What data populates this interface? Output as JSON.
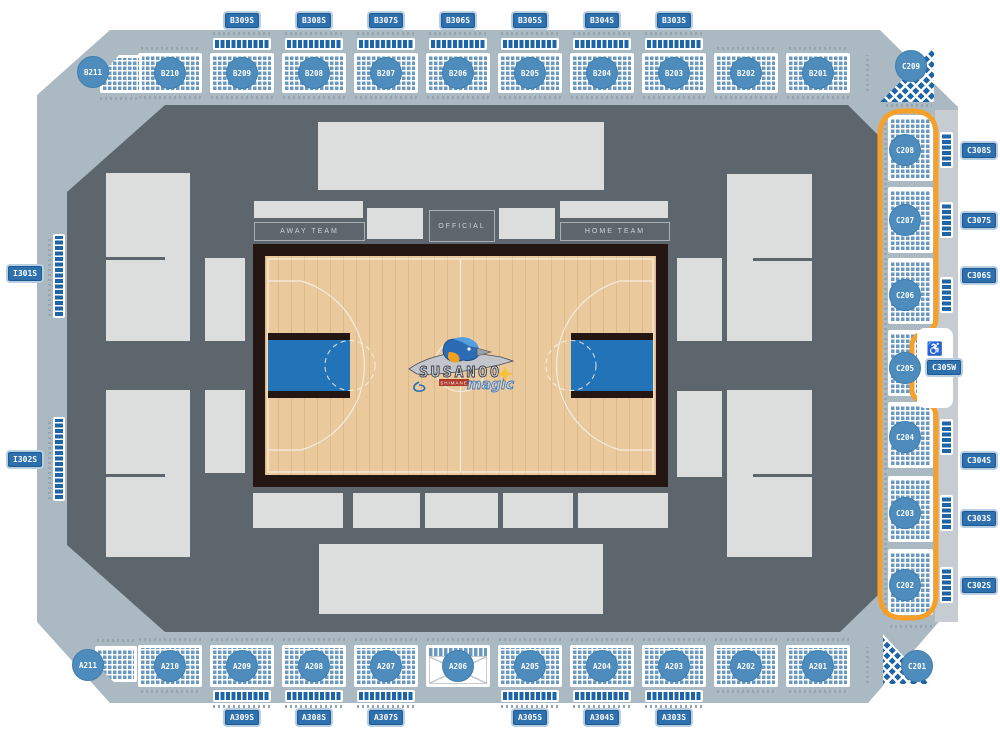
{
  "arena": {
    "title": "Basketball arena seat map",
    "top_badges": [
      "B309S",
      "B308S",
      "B307S",
      "B306S",
      "B305S",
      "B304S",
      "B303S"
    ],
    "bottom_badges": [
      "A309S",
      "A308S",
      "A307S",
      "A305S",
      "A304S",
      "A303S"
    ],
    "left_badges": [
      "I301S",
      "I302S"
    ],
    "right_badges": [
      "C308S",
      "C307S",
      "C306S",
      "C304S",
      "C303S",
      "C302S"
    ],
    "wheelchair_badge": "C305W",
    "wheelchair_icon": "♿",
    "top_sections": [
      "B211",
      "B210",
      "B209",
      "B208",
      "B207",
      "B206",
      "B205",
      "B204",
      "B203",
      "B202",
      "B201"
    ],
    "bottom_sections": [
      "A211",
      "A210",
      "A209",
      "A208",
      "A207",
      "A206",
      "A205",
      "A204",
      "A203",
      "A202",
      "A201"
    ],
    "right_sections": [
      "C209",
      "C208",
      "C207",
      "C206",
      "C205",
      "C204",
      "C203",
      "C202",
      "C201"
    ],
    "court": {
      "away": "AWAY TEAM",
      "official": "OFFICIAL",
      "home": "HOME TEAM"
    },
    "logo": {
      "team": "SUSANOO",
      "word": "magic",
      "sub": "SHIMANE"
    },
    "colors": {
      "ring": "#aab9c2",
      "outer_strip": "#c6ccd1",
      "bowl": "#5d666d",
      "seat": "#6a98c0",
      "suite_seat": "#1e65a8",
      "badge": "#2e6fad",
      "circle": "#4d8cbc",
      "orange": "#f6a02a",
      "court_wood": "#eaca9c",
      "court_border": "#241713",
      "key": "#2373b8"
    }
  }
}
